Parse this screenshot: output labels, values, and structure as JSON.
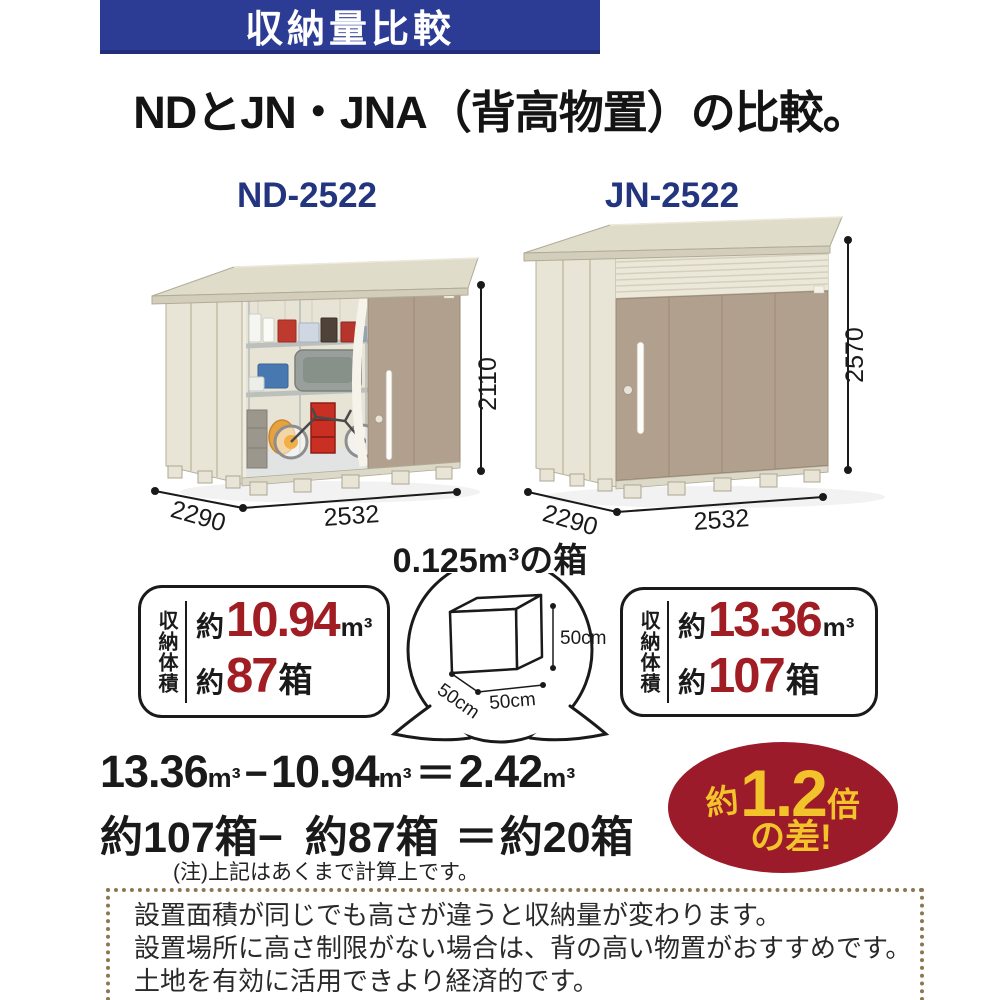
{
  "banner": {
    "label": "収納量比較"
  },
  "title": "NDとJN・JNA（背高物置）の比較。",
  "sheds": [
    {
      "model": "ND-2522",
      "width": "2532",
      "depth": "2290",
      "height": "2110"
    },
    {
      "model": "JN-2522",
      "width": "2532",
      "depth": "2290",
      "height": "2570"
    }
  ],
  "cube": {
    "title": "0.125m³の箱",
    "height_label": "50cm",
    "width_label": "50cm",
    "depth_label": "50cm"
  },
  "stats": [
    {
      "label": "収納体積",
      "volume_prefix": "約",
      "volume": "10.94",
      "volume_unit": "m³",
      "boxes_prefix": "約",
      "boxes": "87",
      "boxes_unit": "箱"
    },
    {
      "label": "収納体積",
      "volume_prefix": "約",
      "volume": "13.36",
      "volume_unit": "m³",
      "boxes_prefix": "約",
      "boxes": "107",
      "boxes_unit": "箱"
    }
  ],
  "formula": {
    "volume_line": {
      "n1": "13.36",
      "n2": "10.94",
      "n3": "2.42",
      "unit": "m³",
      "minus": "−",
      "equals": "＝"
    },
    "box_line": {
      "n1": "約107箱",
      "minus": "−",
      "n2": "約87箱",
      "equals": "＝",
      "n3": "約20箱"
    },
    "note": "(注)上記はあくまで計算上です。"
  },
  "badge": {
    "prefix": "約",
    "value": "1.2",
    "suffix": "倍",
    "line2": "の差!"
  },
  "footer": {
    "line1": "設置面積が同じでも高さが違うと収納量が変わります。",
    "line2": "設置場所に高さ制限がない場合は、背の高い物置がおすすめです。",
    "line3": "土地を有効に活用できより経済的です。"
  },
  "colors": {
    "banner_bg": "#2c3c94",
    "model_label": "#22357e",
    "accent_red": "#a11d24",
    "badge_bg": "#9c1b2a",
    "badge_text": "#f2c32a",
    "footer_dot_border": "#8a7950",
    "shed_wall": "#e9e5d6",
    "shed_door": "#b2a08e"
  }
}
